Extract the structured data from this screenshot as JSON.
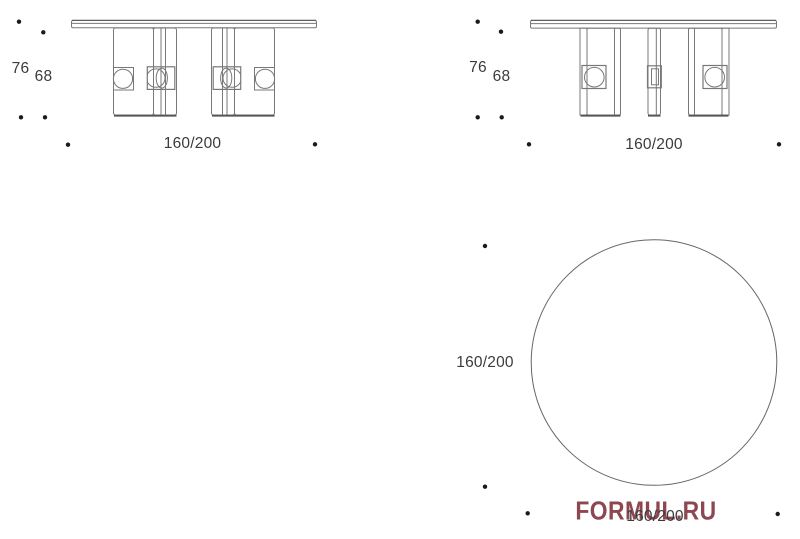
{
  "sheet": {
    "background": "#ffffff",
    "palette": {
      "line": "#787878",
      "dark_line": "#565656",
      "label_text": "#3b3b3b",
      "dot": "#1a1a1a",
      "watermark": "#8d4750"
    }
  },
  "drawings": {
    "front_elevation": {
      "height_label": "76",
      "inner_height_label": "68",
      "width_label": "160/200"
    },
    "side_elevation": {
      "height_label": "76",
      "inner_height_label": "68",
      "depth_label": "160/200"
    },
    "top_plan": {
      "diameter_side_label": "160/200",
      "diameter_bottom_label": "160/200"
    }
  },
  "watermark": {
    "text": "FORMUL.RU"
  }
}
